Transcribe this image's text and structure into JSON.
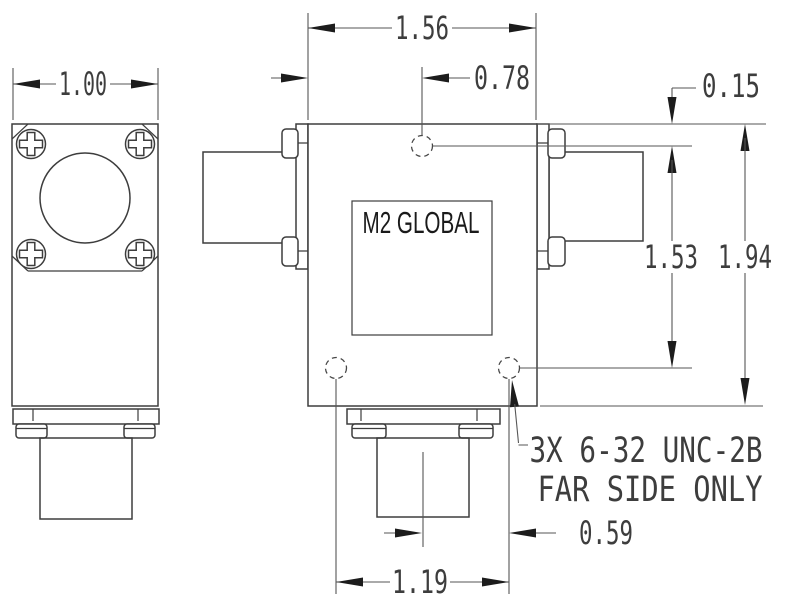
{
  "drawing": {
    "title": "M2 Global RF component outline drawing",
    "units": "inches",
    "brand_label": "M2 GLOBAL",
    "notes": {
      "thread": "3X 6-32 UNC-2B",
      "side": "FAR SIDE ONLY"
    },
    "dims": {
      "side_view_width": "1.00",
      "body_width": "1.56",
      "hole_center_from_left": "0.78",
      "hole_center_from_top": "0.15",
      "hole_vertical_span": "1.53",
      "body_height": "1.94",
      "hole_center_from_connector": "0.59",
      "hole_horizontal_span": "1.19"
    },
    "colors": {
      "object_line": "#3d3d3d",
      "dimension_line": "#565656",
      "arrowhead": "#1c1c1c",
      "background": "#ffffff"
    }
  }
}
